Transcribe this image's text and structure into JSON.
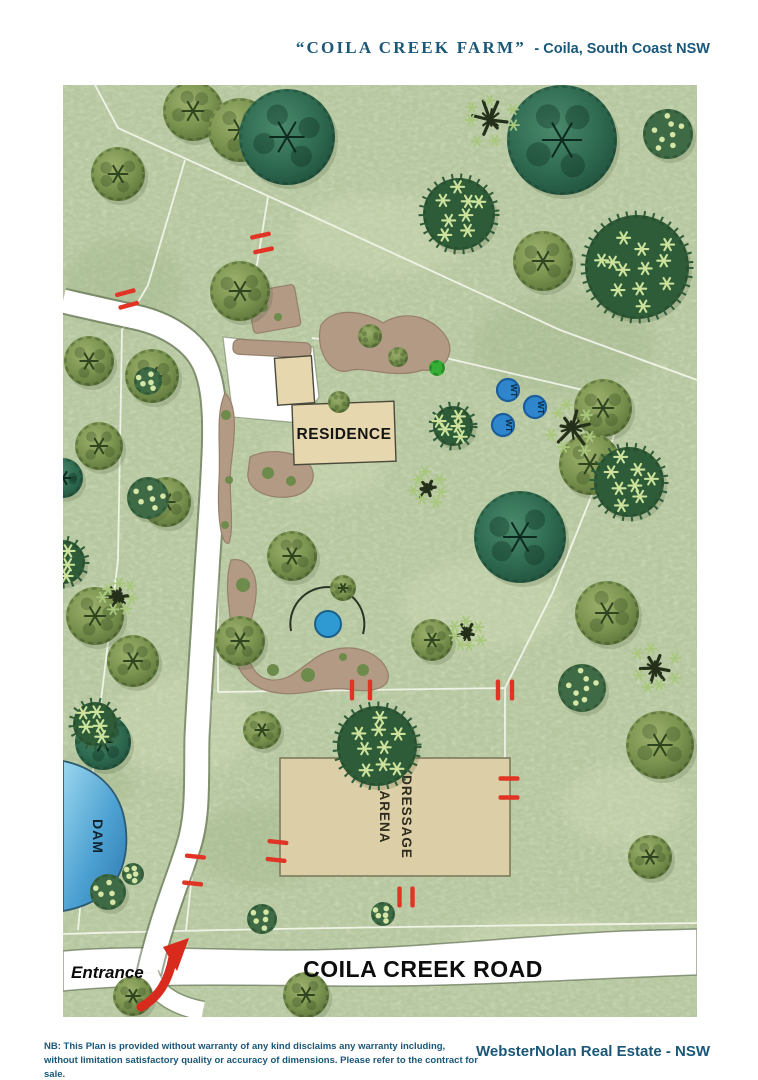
{
  "header": {
    "farm_name": "“COILA CREEK FARM”",
    "location": "- Coila, South Coast NSW"
  },
  "footer": {
    "disclaimer_line1": "NB: This Plan is provided without warranty of any kind disclaims any warranty including,",
    "disclaimer_line2": "without limitation satisfactory quality or accuracy of dimensions. Please refer to the contract for sale.",
    "brand": "WebsterNolan Real Estate - NSW"
  },
  "map": {
    "labels": {
      "residence": "RESIDENCE",
      "dressage_line1": "DRESSAGE",
      "dressage_line2": "ARENA",
      "dam": "DAM",
      "road": "COILA CREEK ROAD",
      "entrance": "Entrance",
      "water_tank": "WT"
    },
    "colors": {
      "navy": "#1a5778",
      "grass": "#b6c7a0",
      "road_white": "#ffffff",
      "fence": "#f2f5ea",
      "gate_red": "#e23424",
      "arrow_red": "#d92a1e",
      "arena_tan": "#dccfa7",
      "building_tan": "#e6d7ae",
      "bed_brown": "#b29a85",
      "dam_blue": "#3f97c9",
      "tank_blue": "#2f86cc",
      "pond_blue": "#2f9ad2"
    },
    "water_tanks": [
      {
        "x": 445,
        "y": 305
      },
      {
        "x": 472,
        "y": 322
      },
      {
        "x": 440,
        "y": 340
      }
    ],
    "gates": [
      {
        "x": 64,
        "y": 214,
        "a": -15,
        "g": 13
      },
      {
        "x": 199,
        "y": 158,
        "a": -12,
        "g": 15
      },
      {
        "x": 298,
        "y": 605,
        "a": 90,
        "g": 18
      },
      {
        "x": 442,
        "y": 605,
        "a": 90,
        "g": 14
      },
      {
        "x": 446,
        "y": 703,
        "a": 0,
        "g": 19
      },
      {
        "x": 214,
        "y": 766,
        "a": 6,
        "g": 18
      },
      {
        "x": 131,
        "y": 785,
        "a": 6,
        "g": 27
      },
      {
        "x": 343,
        "y": 812,
        "a": 90,
        "g": 13
      }
    ],
    "trees": [
      {
        "t": "olive",
        "x": 130,
        "y": 26,
        "r": 30
      },
      {
        "t": "olive",
        "x": 55,
        "y": 89,
        "r": 27
      },
      {
        "t": "olive",
        "x": 177,
        "y": 45,
        "r": 32
      },
      {
        "t": "olive",
        "x": 177,
        "y": 206,
        "r": 30
      },
      {
        "t": "olive",
        "x": 26,
        "y": 276,
        "r": 25
      },
      {
        "t": "olive",
        "x": 89,
        "y": 291,
        "r": 27
      },
      {
        "t": "olive",
        "x": 36,
        "y": 361,
        "r": 24
      },
      {
        "t": "olive",
        "x": 103,
        "y": 417,
        "r": 25
      },
      {
        "t": "olive",
        "x": 32,
        "y": 531,
        "r": 29
      },
      {
        "t": "olive",
        "x": 70,
        "y": 576,
        "r": 26
      },
      {
        "t": "olive",
        "x": 480,
        "y": 176,
        "r": 30
      },
      {
        "t": "olive",
        "x": 540,
        "y": 323,
        "r": 29
      },
      {
        "t": "olive",
        "x": 527,
        "y": 379,
        "r": 31
      },
      {
        "t": "olive",
        "x": 544,
        "y": 528,
        "r": 32
      },
      {
        "t": "olive",
        "x": 597,
        "y": 660,
        "r": 34
      },
      {
        "t": "olive",
        "x": 177,
        "y": 556,
        "r": 25
      },
      {
        "t": "olive",
        "x": 199,
        "y": 645,
        "r": 19
      },
      {
        "t": "olive",
        "x": 229,
        "y": 471,
        "r": 25
      },
      {
        "t": "olive",
        "x": 280,
        "y": 503,
        "r": 13
      },
      {
        "t": "olive",
        "x": 369,
        "y": 555,
        "r": 21
      },
      {
        "t": "olive",
        "x": 587,
        "y": 772,
        "r": 22
      },
      {
        "t": "olive",
        "x": 243,
        "y": 910,
        "r": 23
      },
      {
        "t": "olive",
        "x": 70,
        "y": 911,
        "r": 20
      },
      {
        "t": "olive",
        "x": 276,
        "y": 317,
        "r": 11
      },
      {
        "t": "olive",
        "x": 307,
        "y": 251,
        "r": 12
      },
      {
        "t": "olive",
        "x": 335,
        "y": 272,
        "r": 10
      },
      {
        "t": "dot",
        "x": 605,
        "y": 49,
        "r": 25
      },
      {
        "t": "dot",
        "x": 85,
        "y": 413,
        "r": 21
      },
      {
        "t": "dot",
        "x": 519,
        "y": 603,
        "r": 24
      },
      {
        "t": "dot",
        "x": 45,
        "y": 807,
        "r": 18
      },
      {
        "t": "dot",
        "x": 70,
        "y": 789,
        "r": 11
      },
      {
        "t": "dot",
        "x": 199,
        "y": 834,
        "r": 15
      },
      {
        "t": "dot",
        "x": 320,
        "y": 829,
        "r": 12
      },
      {
        "t": "dot",
        "x": 85,
        "y": 296,
        "r": 14
      },
      {
        "t": "shrub",
        "x": 374,
        "y": 283,
        "r": 8
      },
      {
        "t": "teal",
        "x": 224,
        "y": 52,
        "r": 48
      },
      {
        "t": "teal",
        "x": 499,
        "y": 55,
        "r": 55
      },
      {
        "t": "teal",
        "x": 457,
        "y": 452,
        "r": 46
      },
      {
        "t": "teal",
        "x": 40,
        "y": 657,
        "r": 28
      },
      {
        "t": "teal",
        "x": 0,
        "y": 393,
        "r": 20
      },
      {
        "t": "star",
        "x": 396,
        "y": 129,
        "r": 36
      },
      {
        "t": "star",
        "x": 574,
        "y": 182,
        "r": 52
      },
      {
        "t": "star",
        "x": 566,
        "y": 397,
        "r": 35
      },
      {
        "t": "star",
        "x": 314,
        "y": 661,
        "r": 40
      },
      {
        "t": "star",
        "x": 0,
        "y": 477,
        "r": 22
      },
      {
        "t": "star",
        "x": 390,
        "y": 341,
        "r": 20
      },
      {
        "t": "star",
        "x": 32,
        "y": 639,
        "r": 22
      },
      {
        "t": "dead",
        "x": 427,
        "y": 35,
        "r": 20
      },
      {
        "t": "dead",
        "x": 509,
        "y": 343,
        "r": 20
      },
      {
        "t": "dead",
        "x": 365,
        "y": 403,
        "r": 13
      },
      {
        "t": "dead",
        "x": 404,
        "y": 548,
        "r": 12
      },
      {
        "t": "dead",
        "x": 592,
        "y": 583,
        "r": 18
      },
      {
        "t": "dead",
        "x": 55,
        "y": 512,
        "r": 13
      }
    ]
  }
}
